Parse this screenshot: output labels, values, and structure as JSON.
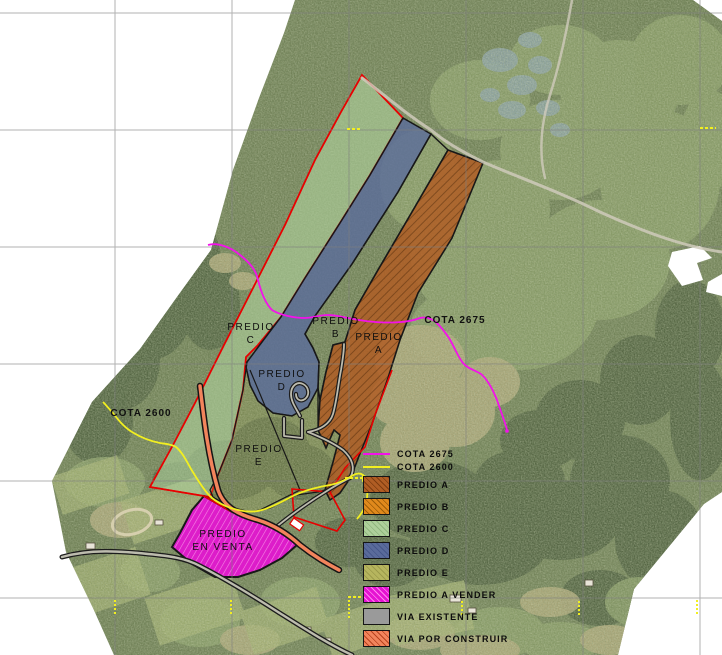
{
  "map": {
    "labels": [
      {
        "id": "label-predio-c",
        "text": "PREDIO\nC",
        "x": 251,
        "y": 321,
        "bold": false
      },
      {
        "id": "label-predio-b",
        "text": "PREDIO\nB",
        "x": 336,
        "y": 315,
        "bold": false
      },
      {
        "id": "label-predio-a",
        "text": "PREDIO\nA",
        "x": 379,
        "y": 331,
        "bold": false
      },
      {
        "id": "label-predio-d",
        "text": "PREDIO\nD",
        "x": 282,
        "y": 368,
        "bold": false
      },
      {
        "id": "label-predio-e",
        "text": "PREDIO\nE",
        "x": 259,
        "y": 443,
        "bold": false
      },
      {
        "id": "label-predio-en-venta",
        "text": "PREDIO\nEN VENTA",
        "x": 223,
        "y": 528,
        "bold": false
      },
      {
        "id": "label-cota-2675",
        "text": "COTA 2675",
        "x": 455,
        "y": 314,
        "bold": true
      },
      {
        "id": "label-cota-2600",
        "text": "COTA 2600",
        "x": 141,
        "y": 407,
        "bold": true
      }
    ]
  },
  "legend": {
    "items": [
      {
        "label": "COTA 2675",
        "type": "line",
        "color": "#f312ea"
      },
      {
        "label": "COTA 2600",
        "type": "line",
        "color": "#f2ef20"
      },
      {
        "label": "PREDIO A",
        "type": "swatch",
        "color": "#b05d24",
        "hatch": "#7e3c10"
      },
      {
        "label": "PREDIO B",
        "type": "swatch",
        "color": "#e0891c",
        "hatch": "#9c5c08"
      },
      {
        "label": "PREDIO C",
        "type": "swatch",
        "color": "#aed09b",
        "hatch": "#8fb67e"
      },
      {
        "label": "PREDIO D",
        "type": "swatch",
        "color": "#5a6b9b",
        "hatch": "#46578a"
      },
      {
        "label": "PREDIO E",
        "type": "swatch",
        "color": "#b6b55e",
        "hatch": "#9b9a4a"
      },
      {
        "label": "PREDIO A VENDER",
        "type": "swatch",
        "color": "#e513d2",
        "hatch": "#ff86ef"
      },
      {
        "label": "VIA EXISTENTE",
        "type": "swatch",
        "color": "#9a9a9a",
        "hatch": null
      },
      {
        "label": "VIA POR CONSTRUIR",
        "type": "swatch",
        "color": "#f2845c",
        "hatch": "#b8431f"
      }
    ]
  },
  "colors": {
    "background": "#ffffff",
    "grid_line": "#7f7f7f",
    "boundary_red": "#e80000",
    "parcel_outline": "#181818",
    "road_casing": "#1c1c1c",
    "road_fill": "#bdbcae",
    "trail": "#cfcabb",
    "cota_2675": "#f312ea",
    "cota_2600": "#f2ef20",
    "predio_a": "#b05d24",
    "predio_a_hatch": "#7e3c10",
    "predio_b": "#e0891c",
    "predio_c": "#aed09b",
    "predio_d": "#5a6b9b",
    "predio_e": "#b6b55e",
    "predio_vender": "#e513d2",
    "predio_vender_hatch": "#ff86ef",
    "via_existente": "#9a9a9a",
    "via_por_construir": "#f2845c"
  }
}
